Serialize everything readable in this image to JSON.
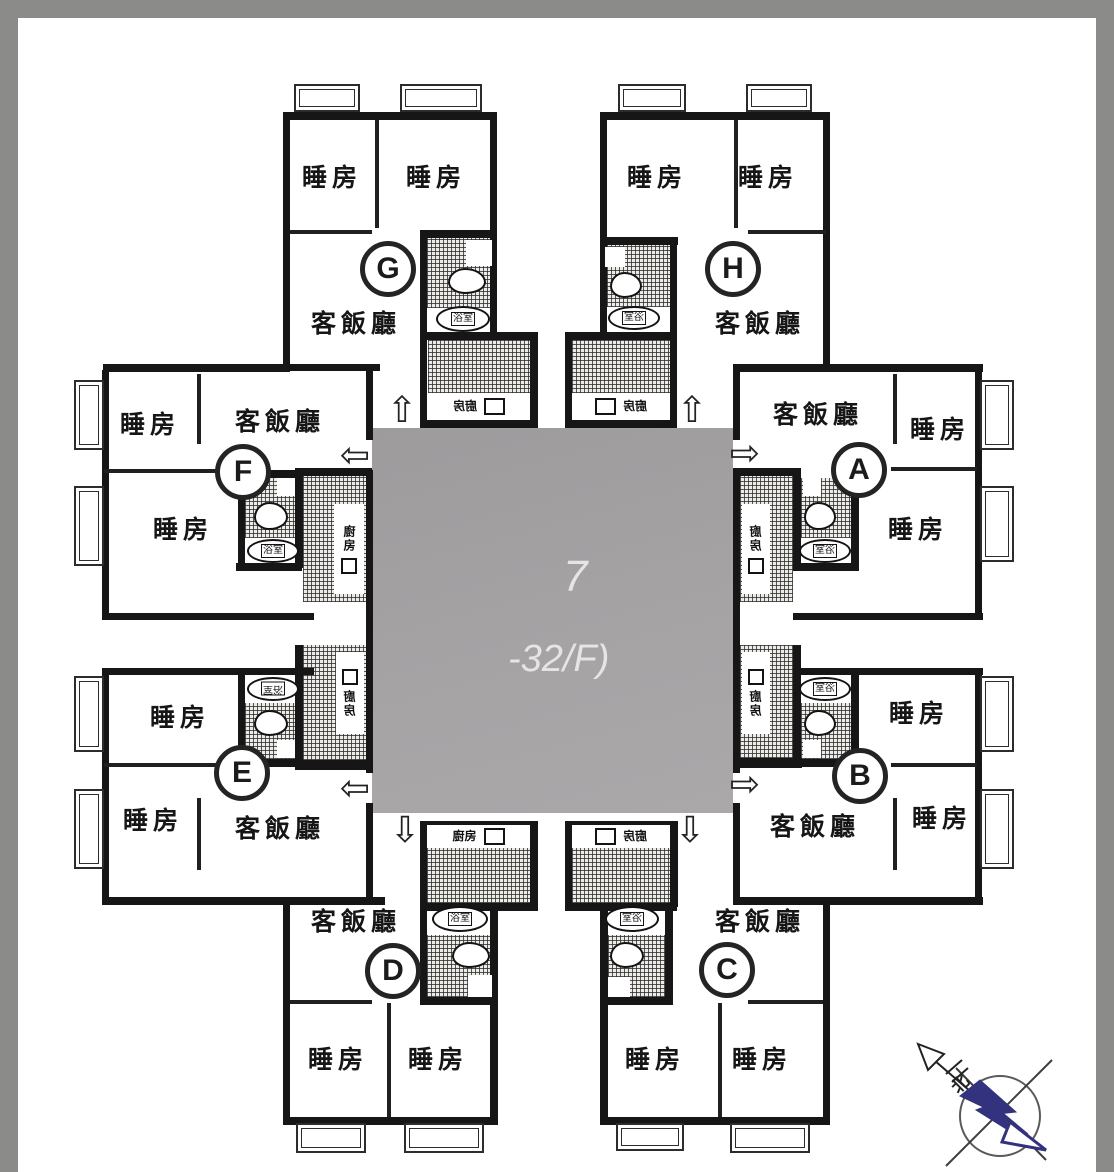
{
  "labels": {
    "bedroom": "睡房",
    "living_dining": "客飯廳",
    "bathroom": "浴室",
    "kitchen": "廚房"
  },
  "units": {
    "a": "A",
    "b": "B",
    "c": "C",
    "d": "D",
    "e": "E",
    "f": "F",
    "g": "G",
    "h": "H"
  },
  "core": {
    "line1": "7",
    "line2": "-32/F)"
  },
  "icons": {
    "arrow_up": "⇧",
    "arrow_down": "⇩",
    "arrow_left": "⇦",
    "arrow_right": "⇨"
  },
  "compass": {
    "north": "北"
  },
  "colors": {
    "wall": "#161616",
    "frame_gray": "#8b8b89",
    "core_gray": "#a3a1a2",
    "compass_navy": "#32327e"
  }
}
